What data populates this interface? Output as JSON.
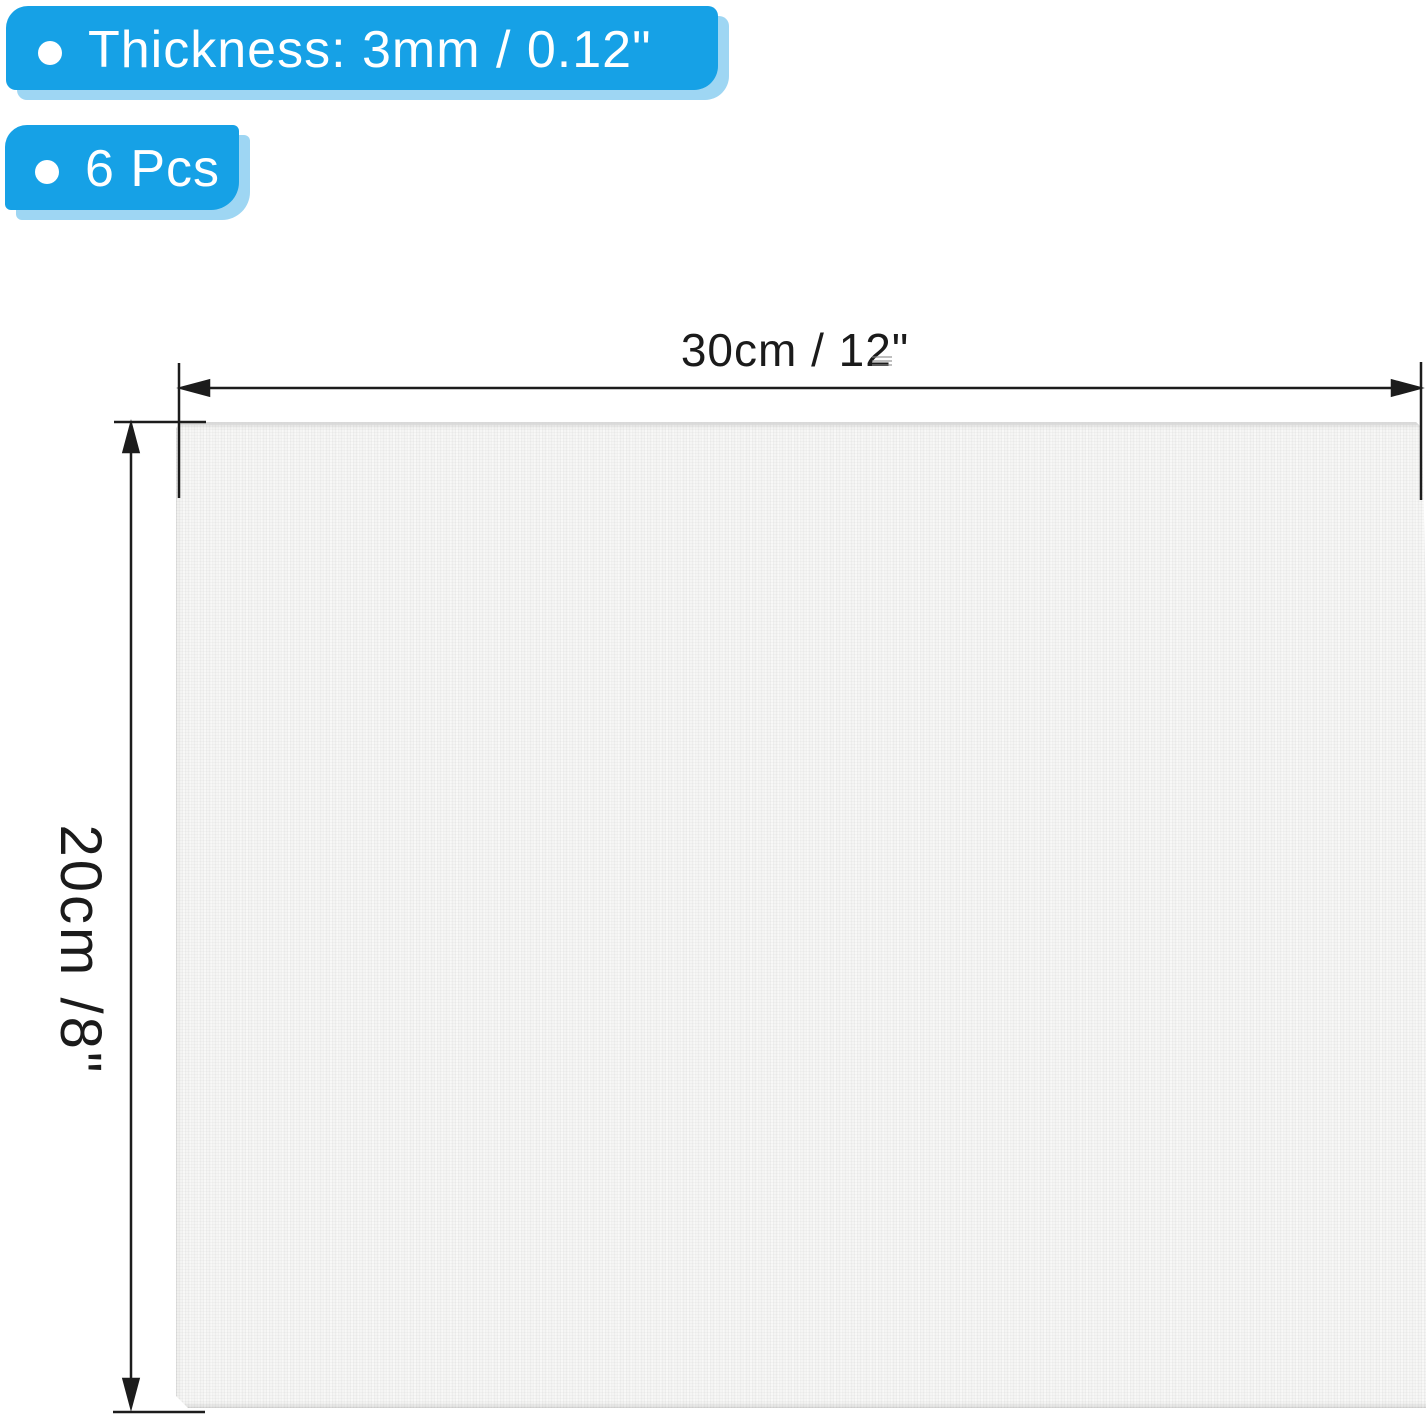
{
  "callouts": [
    {
      "label": "Thickness: 3mm / 0.12\""
    },
    {
      "label": "6 Pcs"
    }
  ],
  "dimension_labels": {
    "width": "30cm / 12\"",
    "height": "20cm /8\""
  },
  "colors": {
    "callout_blue": "#16A1E6",
    "callout_shadow_blue": "#9ED6F3",
    "callout_text": "#FFFFFF",
    "dimension_line": "#1C1C1C",
    "panel_fill": "#F5F5F4",
    "panel_top_edge": "#D9D9D9",
    "background": "#FFFFFF"
  }
}
